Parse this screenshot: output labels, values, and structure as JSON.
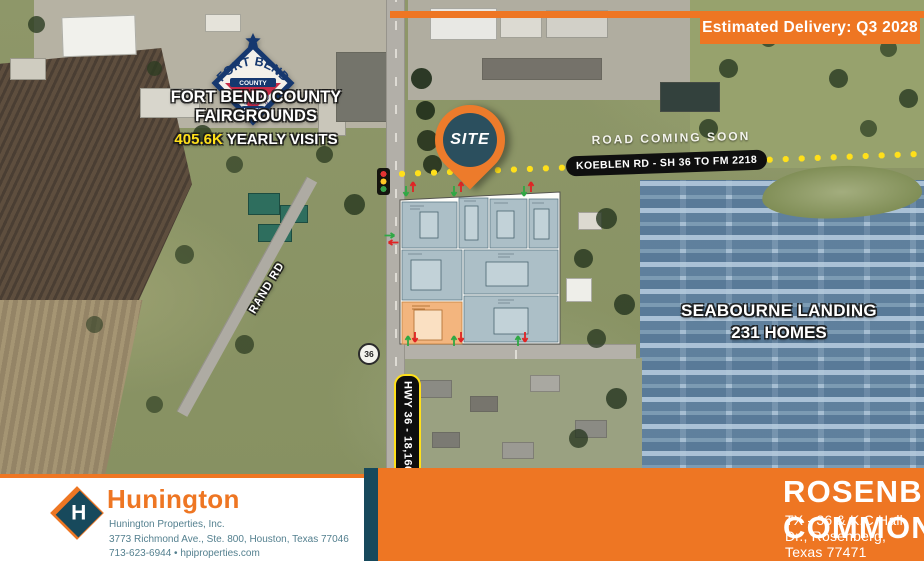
{
  "delivery_badge": "Estimated Delivery: Q3 2028",
  "fair_logo": {
    "arc": "FORT BEND",
    "county": "COUNTY",
    "fair": "FAIR",
    "rodeo": "RODEO"
  },
  "fairgrounds": {
    "line1": "FORT BEND COUNTY",
    "line2": "FAIRGROUNDS",
    "visits_value": "405.6K",
    "visits_label": " YEARLY VISITS"
  },
  "site_pin": "SITE",
  "roads": {
    "coming_soon": "ROAD COMING SOON",
    "koeblen_pill": "KOEBLEN RD - SH 36 TO FM 2218",
    "rand_rd": "RAND RD",
    "hwy_shield": "36",
    "hwy_pill": "HWY 36 - 18,166 VPD"
  },
  "seabourne": {
    "line1": "SEABOURNE LANDING",
    "line2": "231 HOMES"
  },
  "footer": {
    "logo_letter": "H",
    "brand": "Hunington",
    "company": "Hunington Properties, Inc.",
    "address": "3773 Richmond Ave., Ste. 800, Houston, Texas 77046",
    "contact": "713-623-6944 • hpiproperties.com",
    "project_title": "ROSENBERG COMMONS",
    "project_address": "TX - 36 & K.C Hall Dr., Rosenberg, Texas 77471"
  },
  "colors": {
    "accent_orange": "#EE7623",
    "brand_teal": "#17495C",
    "dot_yellow": "#FFE01A",
    "parcel_blue": "#A8BCC4",
    "parcel_orange": "#F3B57E"
  }
}
